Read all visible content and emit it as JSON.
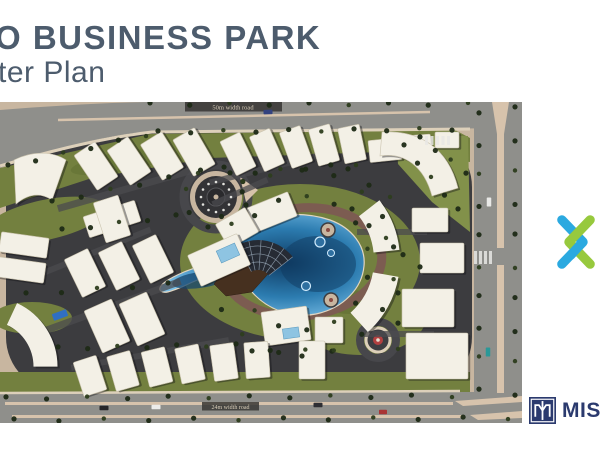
{
  "slide": {
    "title_line1": "O BUSINESS PARK",
    "title_line2": "ter Plan",
    "title_color": "#4d5c6d",
    "background": "#ffffff"
  },
  "brand": {
    "xmark_blue": "#2BA9E0",
    "xmark_green": "#97C93D"
  },
  "partner_logo": {
    "text": "MISR",
    "navy": "#2b3a6e"
  },
  "masterplan": {
    "road_labels": {
      "top": "50m width road",
      "bottom": "24m width road"
    },
    "palette": {
      "sand": "#c8b6a0",
      "asphalt": "#3c3c3f",
      "grass": "#73803f",
      "grass_light": "#82914a",
      "grass_dark": "#5a682f",
      "road": "#8f8f8b",
      "walk": "#ddd0ba",
      "median": "#d7c3ac",
      "ringroad": "#47474b",
      "promenade": "#7c5c51",
      "building": "#f3f0e6",
      "building_edge": "#cac3ae",
      "lane": "#4b4b4f",
      "tree": "#1d2a16",
      "tree_light": "#2d3d1e",
      "water_edge": "#e2d6c2",
      "pool": "#8ec4e2",
      "shadow": "rgba(15,15,20,0.4)"
    },
    "scene": [
      {
        "t": "rect",
        "a": {
          "x": 0,
          "y": 0,
          "width": 522,
          "height": 321,
          "fill": "#c8b6a0"
        }
      },
      {
        "t": "rect",
        "a": {
          "x": 6,
          "y": 30,
          "width": 466,
          "height": 260,
          "rx": 55,
          "fill": "#3c3c3f"
        }
      },
      {
        "t": "path",
        "a": {
          "d": "M0,66 L150,32 L455,28 L470,36 L470,60 L380,50 L210,56 L92,76 L0,106 Z",
          "fill": "#73803f"
        }
      },
      {
        "t": "path",
        "a": {
          "d": "M396,34 L468,34 L470,130 L432,100 L398,62 Z",
          "fill": "#82914a"
        }
      },
      {
        "t": "ellipse",
        "a": {
          "cx": 300,
          "cy": 160,
          "rx": 120,
          "ry": 78,
          "fill": "#73803f"
        }
      },
      {
        "t": "ellipse",
        "a": {
          "cx": 360,
          "cy": 215,
          "rx": 66,
          "ry": 38,
          "fill": "#73803f"
        }
      },
      {
        "t": "rect",
        "a": {
          "x": 0,
          "y": 270,
          "width": 470,
          "height": 20,
          "fill": "#73803f"
        }
      },
      {
        "t": "ellipse",
        "a": {
          "cx": 45,
          "cy": 118,
          "rx": 62,
          "ry": 20,
          "fill": "#73803f",
          "transform": "rotate(-12 45 118)"
        }
      },
      {
        "t": "ellipse",
        "a": {
          "cx": 32,
          "cy": 216,
          "rx": 40,
          "ry": 16,
          "fill": "#73803f"
        }
      },
      {
        "t": "ellipse",
        "a": {
          "cx": 250,
          "cy": 120,
          "rx": 40,
          "ry": 14,
          "fill": "#5a682f",
          "opacity": 0.45
        }
      },
      {
        "t": "ellipse",
        "a": {
          "cx": 350,
          "cy": 200,
          "rx": 30,
          "ry": 12,
          "fill": "#5a682f",
          "opacity": 0.45
        }
      },
      {
        "t": "ellipse",
        "a": {
          "cx": 120,
          "cy": 60,
          "rx": 50,
          "ry": 10,
          "fill": "#5a682f",
          "opacity": 0.4,
          "transform": "rotate(-10 120 60)"
        }
      },
      {
        "t": "path",
        "a": {
          "d": "M0,8 C50,4 100,1 148,0 L522,0 L522,26 L152,29 C110,33 60,44 0,66 Z",
          "fill": "#8f8f8b"
        }
      },
      {
        "t": "rect",
        "a": {
          "x": 474,
          "y": 0,
          "width": 48,
          "height": 321,
          "fill": "#8f8f8b"
        }
      },
      {
        "t": "rect",
        "a": {
          "x": 0,
          "y": 290,
          "width": 522,
          "height": 31,
          "fill": "#8f8f8b"
        }
      },
      {
        "t": "path",
        "a": {
          "d": "M0,64 C40,52 100,36 152,30 L470,27",
          "stroke": "#ddd0ba",
          "stroke-width": 3,
          "fill": "none"
        }
      },
      {
        "t": "line",
        "a": {
          "x1": 58,
          "y1": 18,
          "x2": 430,
          "y2": 10,
          "stroke": "#d7c3ac",
          "stroke-width": 2.5
        }
      },
      {
        "t": "polygon",
        "a": {
          "points": "492,0 509,0 504,32 497,32",
          "fill": "#d7c3ac"
        }
      },
      {
        "t": "rect",
        "a": {
          "x": 497,
          "y": 32,
          "width": 7,
          "height": 114,
          "fill": "#d7c3ac"
        }
      },
      {
        "t": "rect",
        "a": {
          "x": 497,
          "y": 163,
          "width": 7,
          "height": 128,
          "fill": "#d7c3ac"
        }
      },
      {
        "t": "line",
        "a": {
          "x1": 0,
          "y1": 291,
          "x2": 460,
          "y2": 289,
          "stroke": "#ddd0ba",
          "stroke-width": 2.5
        }
      },
      {
        "t": "rect",
        "a": {
          "x": 5,
          "y": 300,
          "width": 448,
          "height": 3,
          "fill": "#d7c3ac"
        }
      },
      {
        "t": "rect",
        "a": {
          "x": 12,
          "y": 313,
          "width": 452,
          "height": 3,
          "fill": "#d7c3ac"
        }
      },
      {
        "t": "polygon",
        "a": {
          "points": "455,299 522,294 522,300 463,304",
          "fill": "#d7c3ac"
        }
      },
      {
        "t": "polygon",
        "a": {
          "points": "470,313 522,309 522,316 478,318",
          "fill": "#d7c3ac"
        }
      },
      {
        "t": "rect",
        "a": {
          "x": 185,
          "y": 0,
          "width": 97,
          "height": 9.5,
          "fill": "#3a3835",
          "opacity": 0.88
        }
      },
      {
        "t": "rect",
        "a": {
          "x": 202,
          "y": 300,
          "width": 57,
          "height": 8.5,
          "fill": "#3a3835",
          "opacity": 0.85
        }
      },
      {
        "t": "circle",
        "a": {
          "cx": 216,
          "cy": 95,
          "r": 32,
          "stroke": "#47474b",
          "stroke-width": 9,
          "fill": "none"
        }
      },
      {
        "t": "circle",
        "a": {
          "cx": 378,
          "cy": 238,
          "r": 18,
          "stroke": "#47474b",
          "stroke-width": 8,
          "fill": "none"
        }
      },
      {
        "t": "ellipse",
        "a": {
          "cx": 302,
          "cy": 160,
          "rx": 80,
          "ry": 54,
          "stroke": "#7c5c51",
          "stroke-width": 9,
          "fill": "none",
          "transform": "rotate(-6 302 160)"
        }
      },
      {
        "t": "path",
        "a": {
          "d": "M240,126 C262,112 300,108 330,118 C352,126 366,144 364,164 C362,186 344,206 316,212 C290,217 266,206 252,190 C246,182 243,176 242,170 C222,168 200,176 184,184 C172,189 163,193 160,188 C158,183 170,176 184,170 C206,161 228,158 238,150 C233,142 234,131 240,126 Z",
          "fill": "url(#wg)",
          "stroke": "#e2d6c2",
          "stroke-width": 1.2
        }
      },
      {
        "t": "ellipse",
        "a": {
          "cx": 318,
          "cy": 162,
          "rx": 38,
          "ry": 28,
          "fill": "#0f3a60",
          "opacity": 0.5
        }
      },
      {
        "t": "ellipse",
        "a": {
          "cx": 200,
          "cy": 178,
          "rx": 28,
          "ry": 8,
          "fill": "#16456e",
          "opacity": 0.75,
          "transform": "rotate(-8 200 178)"
        }
      },
      {
        "t": "circle",
        "a": {
          "cx": 320,
          "cy": 140,
          "r": 5,
          "fill": "#2e6fa0",
          "stroke": "#cfeafc",
          "stroke-width": 1.2
        }
      },
      {
        "t": "circle",
        "a": {
          "cx": 331,
          "cy": 151,
          "r": 3.5,
          "fill": "#2e6fa0",
          "stroke": "#cfeafc",
          "stroke-width": 1
        }
      },
      {
        "t": "circle",
        "a": {
          "cx": 306,
          "cy": 184,
          "r": 4.5,
          "fill": "#2e6fa0",
          "stroke": "#cfeafc",
          "stroke-width": 1.2
        }
      },
      {
        "t": "circle",
        "a": {
          "cx": 328,
          "cy": 128,
          "r": 7,
          "fill": "#c8b6a0",
          "stroke": "#3c3c3f",
          "stroke-width": 1.5
        }
      },
      {
        "t": "circle",
        "a": {
          "cx": 331,
          "cy": 198,
          "r": 7,
          "fill": "#c8b6a0",
          "stroke": "#3c3c3f",
          "stroke-width": 1.5
        }
      },
      {
        "t": "circle",
        "a": {
          "cx": 328,
          "cy": 128,
          "r": 2,
          "fill": "#8a4a42"
        }
      },
      {
        "t": "circle",
        "a": {
          "cx": 331,
          "cy": 198,
          "r": 2,
          "fill": "#8a4a42"
        }
      },
      {
        "t": "polygon",
        "a": {
          "points": "214,182 232,156 262,148 268,172 252,190 226,194",
          "fill": "#46301f",
          "stroke": "#2e1f14",
          "stroke-width": 0.5
        }
      },
      {
        "t": "path",
        "a": {
          "d": "M237.4,143.2 A44,44 0 0 1 292.7,154.9 L269,173.4 A14,14 0 0 0 251.4,169.6 Z",
          "fill": "#262b34"
        }
      },
      {
        "t": "circle",
        "a": {
          "cx": 216,
          "cy": 95,
          "r": 26,
          "fill": "#c8b6a0"
        }
      },
      {
        "t": "circle",
        "a": {
          "cx": 216,
          "cy": 95,
          "r": 21,
          "fill": "#333336"
        }
      },
      {
        "t": "circle",
        "a": {
          "cx": 216,
          "cy": 95,
          "r": 9,
          "fill": "#2a2a2d",
          "stroke": "#56565a",
          "stroke-width": 1
        }
      },
      {
        "t": "circle",
        "a": {
          "cx": 216,
          "cy": 95,
          "r": 2.5,
          "fill": "#c8b6a0"
        }
      },
      {
        "t": "polygon",
        "a": {
          "points": "240,75 258,88 246,100",
          "fill": "#d7c3ac"
        }
      },
      {
        "t": "circle",
        "a": {
          "cx": 378,
          "cy": 238,
          "r": 12,
          "fill": "#3e3e42",
          "stroke": "#ddd0ba",
          "stroke-width": 3
        }
      },
      {
        "t": "circle",
        "a": {
          "cx": 378,
          "cy": 238,
          "r": 5,
          "fill": "#b24040"
        }
      },
      {
        "t": "circle",
        "a": {
          "cx": 378,
          "cy": 238,
          "r": 1.8,
          "fill": "#e8e0d0"
        }
      }
    ],
    "lanes": [
      [
        130,
        86,
        150,
        7,
        -16
      ],
      [
        95,
        150,
        120,
        6,
        -22
      ],
      [
        110,
        205,
        150,
        7,
        -20
      ],
      [
        150,
        252,
        160,
        6,
        -10
      ],
      [
        268,
        66,
        120,
        6,
        -14
      ],
      [
        392,
        130,
        70,
        6,
        0
      ],
      [
        398,
        232,
        72,
        6,
        0
      ],
      [
        240,
        90,
        60,
        6,
        -24
      ]
    ],
    "buildings": [
      [
        96,
        64,
        25,
        42,
        -34
      ],
      [
        129,
        59,
        25,
        42,
        -34
      ],
      [
        162,
        54,
        25,
        42,
        -32
      ],
      [
        194,
        50,
        25,
        42,
        -30
      ],
      [
        238,
        52,
        22,
        38,
        -26
      ],
      [
        267,
        48,
        22,
        38,
        -24
      ],
      [
        296,
        45,
        22,
        38,
        -20
      ],
      [
        324,
        43,
        22,
        38,
        -16
      ],
      [
        352,
        42,
        22,
        36,
        -12
      ],
      [
        385,
        48,
        32,
        22,
        -6
      ],
      [
        417,
        43,
        28,
        20,
        -4
      ],
      [
        447,
        38,
        24,
        16,
        0
      ],
      [
        430,
        118,
        36,
        24,
        0
      ],
      [
        442,
        156,
        44,
        30,
        0
      ],
      [
        428,
        206,
        52,
        38,
        0
      ],
      [
        437,
        254,
        62,
        46,
        0
      ],
      [
        272,
        110,
        44,
        26,
        -22
      ],
      [
        237,
        126,
        34,
        28,
        -30
      ],
      [
        219,
        158,
        54,
        34,
        -24
      ],
      [
        85,
        171,
        26,
        42,
        -26
      ],
      [
        119,
        164,
        26,
        42,
        -26
      ],
      [
        153,
        157,
        26,
        42,
        -26
      ],
      [
        107,
        224,
        30,
        46,
        -24
      ],
      [
        142,
        217,
        30,
        46,
        -24
      ],
      [
        24,
        143,
        48,
        20,
        8
      ],
      [
        21,
        168,
        48,
        20,
        8
      ],
      [
        112,
        117,
        54,
        22,
        -18
      ],
      [
        112,
        117,
        26,
        42,
        -18
      ],
      [
        286,
        224,
        46,
        34,
        -8
      ],
      [
        329,
        228,
        28,
        26,
        0
      ],
      [
        90,
        274,
        24,
        36,
        -18
      ],
      [
        123,
        269,
        24,
        36,
        -16
      ],
      [
        157,
        265,
        24,
        36,
        -14
      ],
      [
        190,
        262,
        24,
        36,
        -12
      ],
      [
        224,
        260,
        24,
        36,
        -8
      ],
      [
        257,
        258,
        24,
        36,
        -4
      ],
      [
        312,
        258,
        26,
        38,
        0
      ]
    ],
    "path_buildings": [
      {
        "d": "M14,58 C34,48 54,50 66,58 L52,98 C40,90 28,92 16,102 Z"
      },
      {
        "d": "M382,30 C420,28 448,46 458,86 L432,94 C424,64 404,50 380,54 Z"
      }
    ],
    "arc_buildings": [
      {
        "d": "M369.2,106.3 A84,84 0 0 1 386.5,149.2",
        "w": 26
      },
      {
        "d": "M385.7,172.6 A84,84 0 0 1 359.2,220.4",
        "w": 26
      },
      {
        "d": "M45.5,264.6 A58,58 0 0 0 12,212",
        "w": 24
      }
    ],
    "pools": [
      [
        228,
        151,
        20,
        13,
        -24
      ],
      [
        291,
        231,
        16,
        10,
        -8
      ]
    ],
    "fan": {
      "cx": 258,
      "cy": 182,
      "r1": 14,
      "r2": 44,
      "a1": -118,
      "a2": -38,
      "rings": [
        22,
        30,
        38
      ],
      "spokes": 5,
      "color": "#93a2b2"
    },
    "dot_rings": [
      {
        "cx": 216,
        "cy": 95,
        "r": 15,
        "n": 12,
        "dr": 1.3,
        "fill": "#e2e2de"
      }
    ],
    "tree_lines": [
      [
        8,
        64,
        146,
        33,
        6
      ],
      [
        158,
        30,
        452,
        27,
        10
      ],
      [
        150,
        2,
        468,
        2,
        9
      ],
      [
        479,
        12,
        479,
        286,
        10
      ],
      [
        515,
        6,
        515,
        292,
        10
      ],
      [
        6,
        296,
        452,
        294,
        12
      ],
      [
        14,
        318,
        508,
        316,
        12
      ],
      [
        404,
        44,
        458,
        108,
        5
      ],
      [
        420,
        36,
        466,
        70,
        4
      ],
      [
        52,
        100,
        198,
        70,
        6
      ],
      [
        230,
        72,
        356,
        62,
        6
      ],
      [
        62,
        128,
        176,
        114,
        5
      ],
      [
        26,
        192,
        168,
        182,
        5
      ],
      [
        58,
        246,
        236,
        243,
        7
      ],
      [
        252,
        250,
        332,
        248,
        4
      ],
      [
        352,
        108,
        420,
        166,
        5
      ],
      [
        398,
        192,
        398,
        248,
        3
      ],
      [
        348,
        68,
        390,
        96,
        3
      ]
    ],
    "tree_arcs": [
      [
        302,
        161,
        93,
        -150,
        150,
        16
      ],
      [
        302,
        161,
        67,
        -135,
        135,
        12
      ],
      [
        216,
        95,
        31,
        -30,
        330,
        9
      ]
    ],
    "cars": [
      [
        268,
        10,
        9,
        4.5,
        "#33427f",
        -2
      ],
      [
        489,
        100,
        4.5,
        9,
        "#e8e8e6",
        0
      ],
      [
        488,
        250,
        4.5,
        9,
        "#2a9898",
        0
      ],
      [
        104,
        306,
        9,
        4.5,
        "#26262a",
        0
      ],
      [
        156,
        305,
        9,
        4.5,
        "#ececea",
        0
      ],
      [
        318,
        303,
        9,
        4.5,
        "#2e2e33",
        0
      ],
      [
        383,
        310,
        8,
        4.5,
        "#a83434",
        0
      ],
      [
        60,
        213,
        15,
        7,
        "#2f6fc4",
        -20
      ]
    ],
    "crosswalks": [
      {
        "x": 474,
        "y": 149,
        "n": 4,
        "dx": 5,
        "w": 3,
        "h": 13
      },
      {
        "x": 425,
        "y": 34,
        "n": 5,
        "dx": 5.5,
        "w": 3,
        "h": 9
      }
    ]
  }
}
